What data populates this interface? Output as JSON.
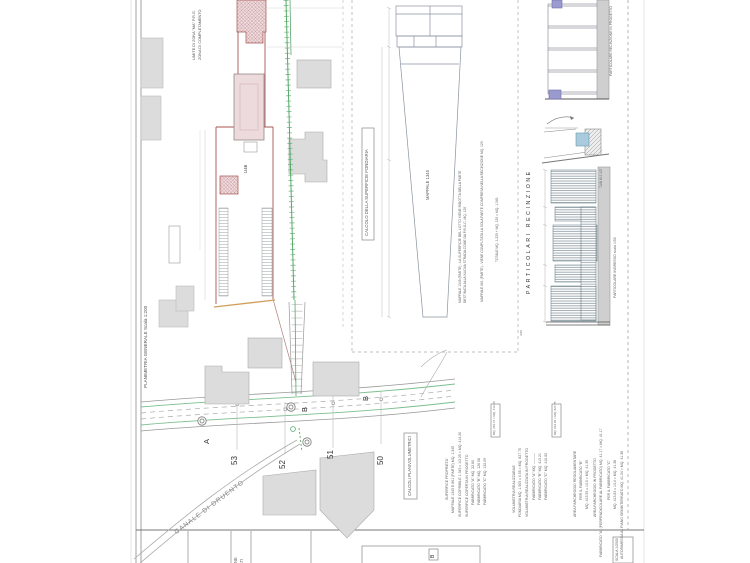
{
  "sheet": {
    "strip_label": "PLANIMETRIA GENERALE   Scala 1:200"
  },
  "site_plan": {
    "zone_limit_1": "LIMITE DI ZONA \"MA\" P.R.G.",
    "zone_limit_2": "ZONA DI COMPLETAMENTO",
    "u46": "U46",
    "canal": "CANALE DI DRUENTO",
    "parcel_53": "53",
    "parcel_52": "52",
    "parcel_51": "51",
    "parcel_50": "50",
    "point_a": "A",
    "point_b1": "B",
    "point_b2": "B"
  },
  "surface_calc": {
    "title": "CALCOLO DELLA SUPERFICIE FONDIARIA",
    "mappale": "MAPPALE 1345",
    "note1": "MAPPALE 1345 (PARTE) - LA SUPERFICIE DEL LOTTO VIENE RIDOTTA DELLA PARTE",
    "note2": "DESTINATA ALLA NUOVA STRADA COME DA P.R.G.C. MQ. 120",
    "note3": "MAPPALE 861 (PARTE) - VIENE COMPUTATA LA SOLA PARTE COMPRESA NELLA RECINZIONE MQ. 120",
    "note4": "TOTALE  MQ. 1.225 + MQ. 120 = MQ. 1.345"
  },
  "fence": {
    "section_title": "PARTICOLARI RECINZIONE",
    "top_label": "PARTICOLARE RECINZIONE IN PROGETTO",
    "entrance_label": "PARTICOLARE INGRESSO  scala 1/50",
    "pipe_note": "TUBI Ø 2 1/2\"",
    "dim_note": "4.00"
  },
  "calc_block": {
    "title": "CALCOLI PLANIVOLUMETRICI",
    "col1": [
      "SUPERFICE  PROPRIETA'",
      "MAPPALE 1345 E 861 (PARTE)  MQ. 1.345",
      "SUPERFICE COPRIBILE  1.345 x 1/3.25 = MQ. 414.20",
      "SUPERFICE COPERTA IN PROGETTO",
      "FABBRICATO \"A\"  MQ.  22.80",
      "FABBRICATO \"B\"  MQ. 126.58",
      "FABBRICATO \"C\"  MQ. 132.09"
    ],
    "box1": "MQ. 281.47 < MQ. 414.20",
    "col2": [
      "VOLUMETRIA REALIZZABILE",
      "FONDIARIA  MQ. 1.505 x 0.55 = MQ. 827.75",
      "VOLUMETRIA REALIZZATA IN PROGETTO",
      "FABBRICATO \"A\"  MQ.  ———",
      "FABBRICATO \"B\"  MQ. 413.21",
      "FABBRICATO \"C\"  MQ. 410.82"
    ],
    "box2": "MQ. 824.03 < MQ. 827.75",
    "col3": [
      "AREA PARCHEGGIO REGOLAMENTARE",
      "PER IL FABBRICATO \"B\"",
      "MQ. 413.55 x 1/10 = MQ. 41.35",
      "AREA PARCHEGGIO IN PROGETTO",
      "FABBRICATO \"A\"  (PERPENDICOLARE AL FABBRICATO)  MQ. 41.17 = MQ. 41.17",
      "PER IL FABBRICATO \"C\"",
      "MQ. 413.83 x 1/10 = MQ. 41.38",
      "AUTORIMESSA AL PIANO SEMINTERRATO  MQ. 41.34 > MQ. 41.38"
    ],
    "b_mark": "B"
  },
  "footer": {
    "loc1": "UBICAZIONE",
    "loc2": "FABBRICATI",
    "scale_box": "SCALA 1/2500"
  },
  "colors": {
    "red_boundary": "#a8544e",
    "green_fence": "#55a868",
    "orange_line": "#cf9f5a",
    "pink_fill": "#eedadc",
    "gray_fill": "#dcdcdc",
    "blue_gate": "#aacadd",
    "purple_post": "#9a9ace"
  }
}
